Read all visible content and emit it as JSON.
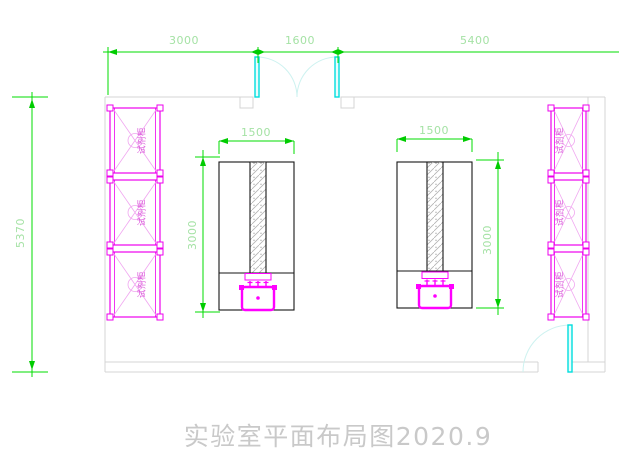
{
  "title": "实验室平面布局图2020.9",
  "dims": {
    "top_left": "3000",
    "top_mid": "1600",
    "top_right": "5400",
    "room_height": "5370",
    "bench_width_left": "1500",
    "bench_depth_left": "3000",
    "bench_width_right": "1500",
    "bench_depth_right": "3000"
  },
  "cabinet_label": "试剂柜",
  "colors": {
    "dimension_line": "#00dd00",
    "dimension_text": "#a5e2a5",
    "cabinet": "#ee00ee",
    "apparatus": "#ff00ff",
    "door": "#00dede",
    "door_swing": "#cdf2f0",
    "wall": "#d4d4d4",
    "bench_outline": "#161616",
    "title_text": "#c9c9c9"
  }
}
